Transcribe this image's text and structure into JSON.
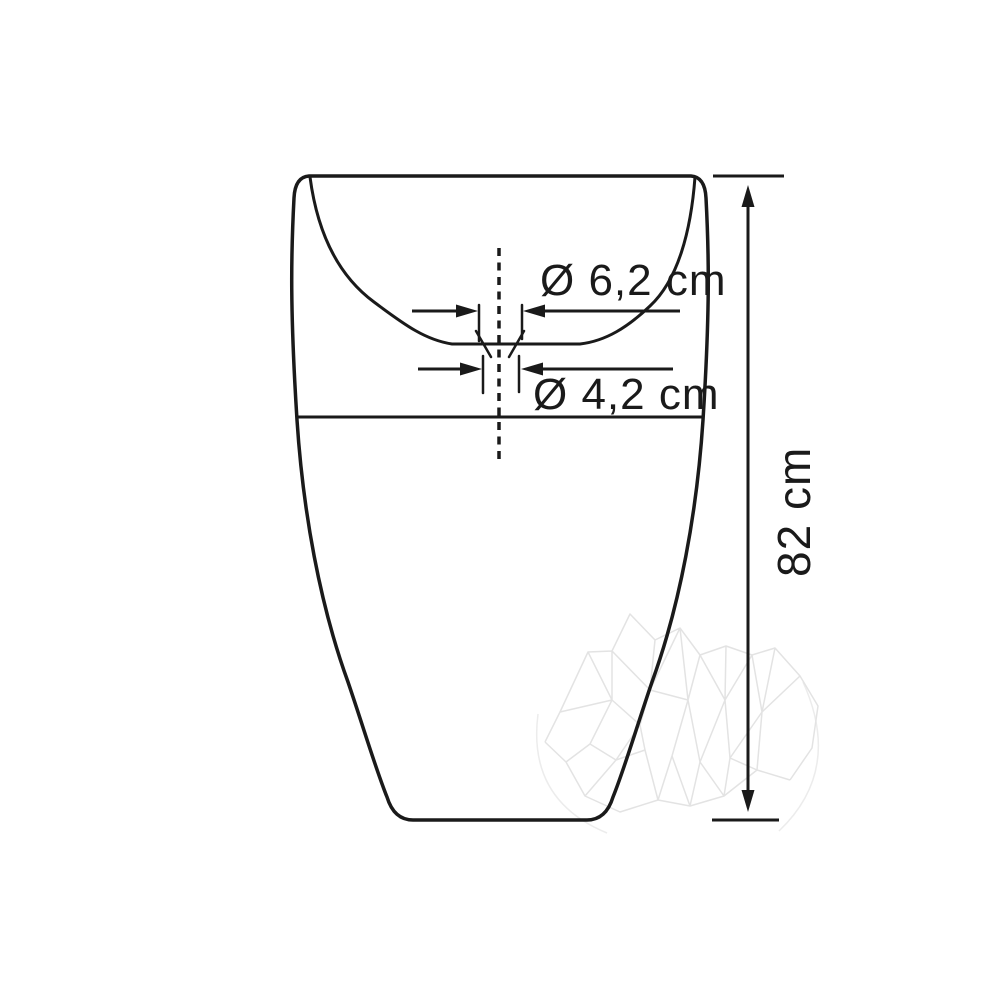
{
  "drawing": {
    "title": "Pedestal washbasin technical drawing - front view",
    "labels": {
      "top_diameter": "Ø 6,2 cm",
      "drain_diameter": "Ø 4,2 cm",
      "height": "82 cm"
    },
    "colors": {
      "line": "#1a1a1a",
      "watermark": "#e3e3e3",
      "background": "#ffffff"
    }
  }
}
